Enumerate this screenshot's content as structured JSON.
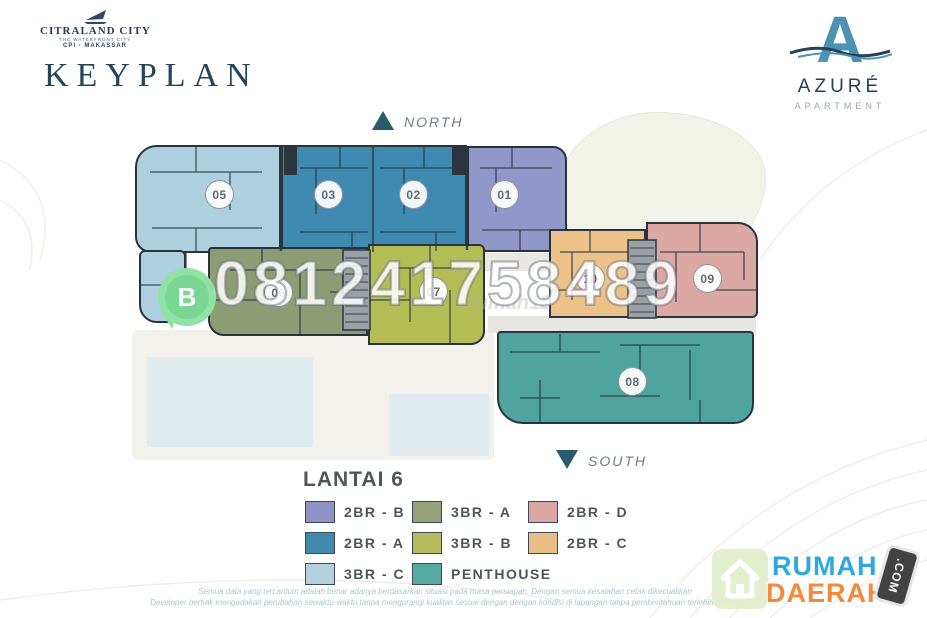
{
  "header": {
    "citraland": {
      "name": "CITRALAND CITY",
      "tagline": "THE WATERFRONT CITY",
      "sub": "CPI - MAKASSAR"
    },
    "title": "KEYPLAN",
    "azure": {
      "monogram": "A",
      "name": "AZURÉ",
      "subtitle": "APARTMENT"
    }
  },
  "compass": {
    "north_label": "NORTH",
    "south_label": "SOUTH"
  },
  "watermark": {
    "phone": "081241758489",
    "whatsapp_badge": "B",
    "faint_text": "rumah12"
  },
  "floorplan": {
    "units": [
      {
        "number": "05",
        "type": "3BR - C",
        "color": "#aed0de"
      },
      {
        "number": "03",
        "type": "2BR - A",
        "color": "#3e8ab1"
      },
      {
        "number": "02",
        "type": "2BR - A",
        "color": "#3e8ab1"
      },
      {
        "number": "01",
        "type": "2BR - B",
        "color": "#9198c9"
      },
      {
        "number": "06",
        "type": "3BR - A",
        "color": "#8e9c74"
      },
      {
        "number": "07",
        "type": "3BR - B",
        "color": "#b2bd55"
      },
      {
        "number": "10",
        "type": "2BR - C",
        "color": "#ecc288"
      },
      {
        "number": "09",
        "type": "2BR - D",
        "color": "#dba8a4"
      },
      {
        "number": "08",
        "type": "PENTHOUSE",
        "color": "#4fa4a0"
      }
    ]
  },
  "legend": {
    "floor_label": "LANTAI 6",
    "items": [
      {
        "label": "2BR - B",
        "color": "#8e93c4"
      },
      {
        "label": "2BR - A",
        "color": "#4189ad"
      },
      {
        "label": "3BR - C",
        "color": "#b4d0dc"
      },
      {
        "label": "3BR - A",
        "color": "#95a17b"
      },
      {
        "label": "3BR - B",
        "color": "#b5bd5e"
      },
      {
        "label": "PENTHOUSE",
        "color": "#55a9a1"
      },
      {
        "label": "2BR - D",
        "color": "#d9a7a4"
      },
      {
        "label": "2BR - C",
        "color": "#e9bd86"
      }
    ]
  },
  "footer": {
    "disclaimer_line1": "Semua data yang tercantum adalah benar adanya berdasarkan situasi pada masa persiapan. Dengan semua kesalahan cetak dikecualikan",
    "disclaimer_line2": "Developer berhak mengadakan perubahan sewaktu-waktu tanpa mengurangi kualitas sesuai dengan dengan kondisi di lapangan tanpa pemberitahuan terlebih dahulu",
    "site_logo": {
      "word_top": "RUMAH",
      "word_bottom": "DAERAH",
      "badge": ".COM"
    }
  }
}
